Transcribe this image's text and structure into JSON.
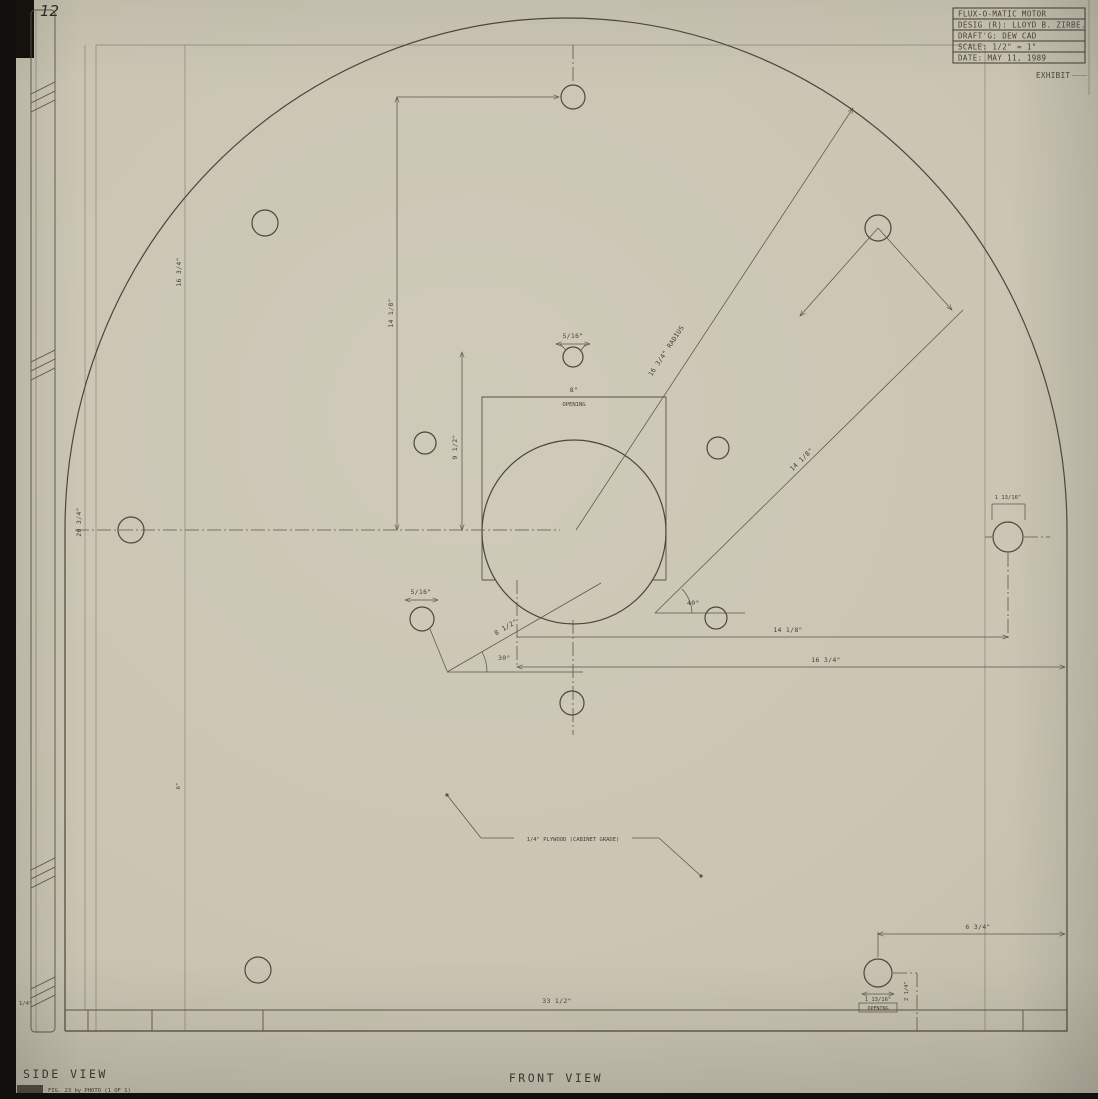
{
  "page": {
    "page_number": "12"
  },
  "title_block": {
    "rows": [
      "FLUX-O-MATIC MOTOR",
      "DESIG (R): LLOYD B. ZIRBE.",
      "DRAFT'G: DEW CAD",
      "SCALE: 1/2\" = 1\"",
      "DATE: MAY 11, 1989"
    ],
    "exhibit": "EXHIBIT"
  },
  "views": {
    "side": "SIDE VIEW",
    "front": "FRONT VIEW",
    "fig_caption": "FIG. 23  by PHOTO (1 OF 1)"
  },
  "dimensions": {
    "radius_line": "16 3/4\" RADIUS",
    "v_16_34": "16 3/4\"",
    "v_14_18": "14 1/8\"",
    "v_20_34": "20 3/4\"",
    "v_9_12": "9 1/2\"",
    "v_6": "6\"",
    "opening_w": "8\"",
    "opening_lbl": "OPENING",
    "hole_5_16_top": "5/16\"",
    "hole_5_16_low": "5/16\"",
    "diag_14_18": "14 1/8\"",
    "diag_8_12": "8 1/2\"",
    "angle_30": "30°",
    "angle_40": "40°",
    "h_14_18": "14 1/8\"",
    "h_16_34": "16 3/4\"",
    "right_hole_1_13_16": "1 13/16\"",
    "br_6_34": "6 3/4\"",
    "br_2_14": "2 1/4\"",
    "br_opening_size": "1 13/16\"",
    "br_opening_lbl": "OPENING",
    "bottom_33_12": "33 1/2\"",
    "side_thickness": "1/4\"",
    "note_plywood": "1/4\" PLYWOOD (CABINET GRADE)"
  }
}
